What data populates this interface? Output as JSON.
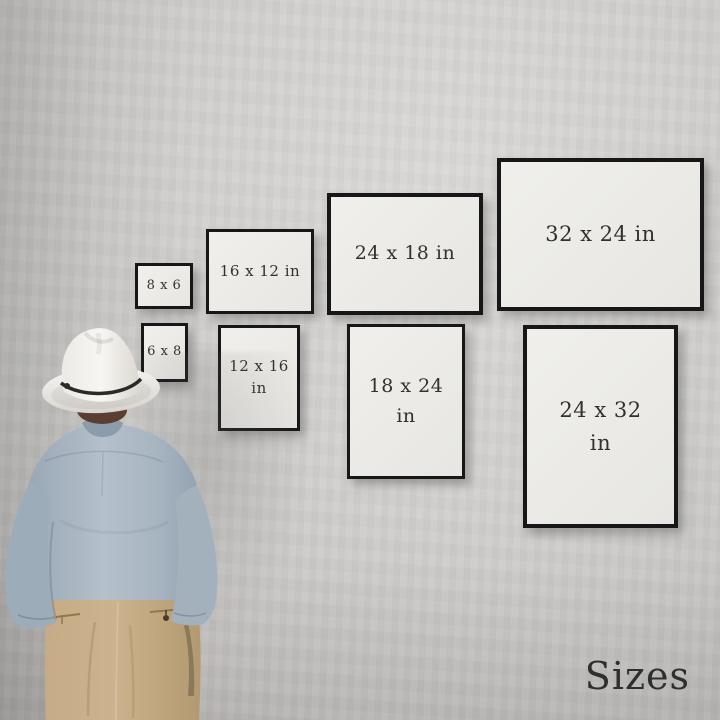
{
  "scene": {
    "caption": "Sizes",
    "figure_name": "man-in-white-hat-viewing-gallery-wall"
  },
  "frames": [
    {
      "id": "8x6",
      "orientation": "landscape",
      "line1": "8 x 6",
      "line2": ""
    },
    {
      "id": "16x12",
      "orientation": "landscape",
      "line1": "16 x 12 in",
      "line2": ""
    },
    {
      "id": "24x18",
      "orientation": "landscape",
      "line1": "24 x 18 in",
      "line2": ""
    },
    {
      "id": "32x24",
      "orientation": "landscape",
      "line1": "32 x 24 in",
      "line2": ""
    },
    {
      "id": "6x8",
      "orientation": "portrait",
      "line1": "6 x 8",
      "line2": ""
    },
    {
      "id": "12x16",
      "orientation": "portrait",
      "line1": "12 x 16",
      "line2": "in"
    },
    {
      "id": "18x24",
      "orientation": "portrait",
      "line1": "18 x 24",
      "line2": "in"
    },
    {
      "id": "24x32",
      "orientation": "portrait",
      "line1": "24 x 32",
      "line2": "in"
    }
  ],
  "colors": {
    "wall": "#cdccca",
    "frame_border": "#171717",
    "frame_mat": "#ecebe8",
    "label_text": "#32312d",
    "caption_text": "#2f2f2d",
    "hat": "#f2f1ee",
    "hat_band": "#2c2a26",
    "hair": "#5a3e30",
    "shirt": "#aab7c3",
    "pants": "#c4aa83"
  }
}
